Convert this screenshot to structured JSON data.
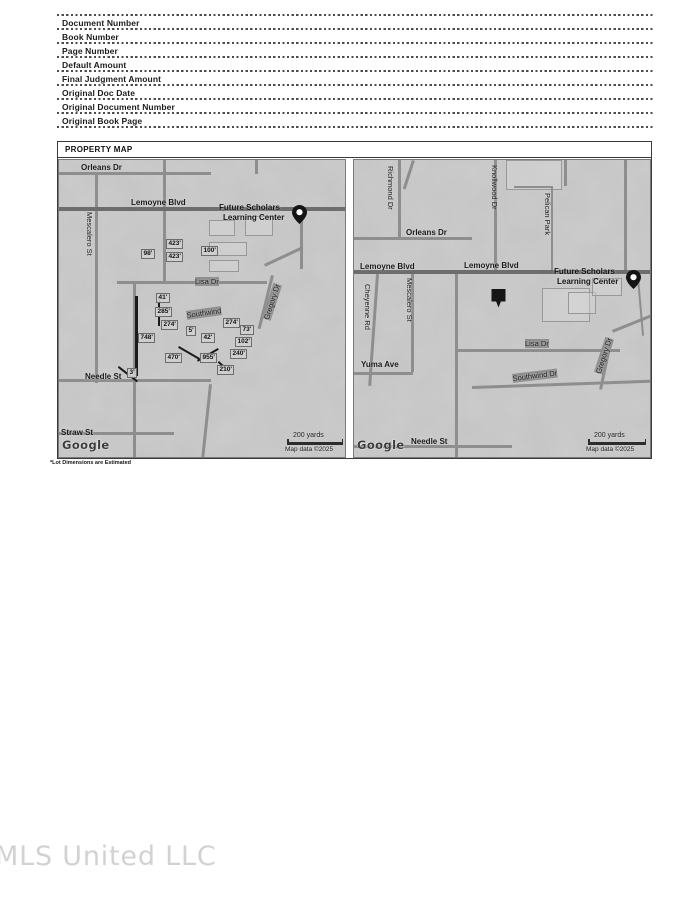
{
  "form": {
    "fields": [
      "Document Number",
      "Book Number",
      "Page Number",
      "Default Amount",
      "Final Judgment Amount",
      "Original Doc Date",
      "Original Document Number",
      "Original Book Page"
    ]
  },
  "property_map": {
    "title": "PROPERTY MAP",
    "footnote": "*Lot Dimensions are Estimated",
    "maps": {
      "left": {
        "labels": [
          {
            "t": "Orleans Dr",
            "x": 22,
            "y": 3,
            "cls": "roadb"
          },
          {
            "t": "Lemoyne Blvd",
            "x": 72,
            "y": 38,
            "cls": "roadb"
          },
          {
            "t": "Mescalero St",
            "x": 26,
            "y": 52,
            "cls": "vert"
          },
          {
            "t": "Future Scholars",
            "x": 160,
            "y": 43,
            "cls": "poi"
          },
          {
            "t": "Learning Center",
            "x": 164,
            "y": 53,
            "cls": "poi"
          },
          {
            "t": "98'",
            "x": 82,
            "y": 89,
            "cls": "dim"
          },
          {
            "t": "423'",
            "x": 107,
            "y": 79,
            "cls": "dim"
          },
          {
            "t": "423'",
            "x": 107,
            "y": 92,
            "cls": "dim"
          },
          {
            "t": "100'",
            "x": 142,
            "y": 86,
            "cls": "dim"
          },
          {
            "t": "Lisa Dr",
            "x": 136,
            "y": 117,
            "cls": "road"
          },
          {
            "t": "Gregory Dr",
            "x": 203,
            "y": 158,
            "cls": "road",
            "rot": -72
          },
          {
            "t": "41'",
            "x": 97,
            "y": 133,
            "cls": "dim"
          },
          {
            "t": "285'",
            "x": 96,
            "y": 147,
            "cls": "dim"
          },
          {
            "t": "Southwind",
            "x": 127,
            "y": 151,
            "cls": "road",
            "rot": -8
          },
          {
            "t": "274'",
            "x": 102,
            "y": 160,
            "cls": "dim"
          },
          {
            "t": "748'",
            "x": 79,
            "y": 173,
            "cls": "dim"
          },
          {
            "t": "5'",
            "x": 127,
            "y": 166,
            "cls": "dim"
          },
          {
            "t": "42'",
            "x": 142,
            "y": 173,
            "cls": "dim"
          },
          {
            "t": "274'",
            "x": 164,
            "y": 158,
            "cls": "dim"
          },
          {
            "t": "73'",
            "x": 181,
            "y": 165,
            "cls": "dim"
          },
          {
            "t": "102'",
            "x": 176,
            "y": 177,
            "cls": "dim"
          },
          {
            "t": "240'",
            "x": 171,
            "y": 189,
            "cls": "dim"
          },
          {
            "t": "470'",
            "x": 106,
            "y": 193,
            "cls": "dim"
          },
          {
            "t": "955'",
            "x": 141,
            "y": 193,
            "cls": "dim"
          },
          {
            "t": "210'",
            "x": 158,
            "y": 205,
            "cls": "dim"
          },
          {
            "t": "3'",
            "x": 68,
            "y": 208,
            "cls": "dim"
          },
          {
            "t": "Needle St",
            "x": 26,
            "y": 212,
            "cls": "roadb"
          },
          {
            "t": "Straw St",
            "x": 2,
            "y": 268,
            "cls": "roadb"
          },
          {
            "t": "Google",
            "x": 3,
            "y": 278,
            "cls": "google"
          },
          {
            "t": "200 yards",
            "x": 234,
            "y": 272,
            "cls": "scalelab"
          },
          {
            "t": "Map data ©2025",
            "x": 226,
            "y": 286,
            "cls": "attrib"
          }
        ],
        "scale_bar": {
          "x": 228,
          "y": 282,
          "w": 56
        },
        "markers": [
          {
            "type": "location-pin",
            "x": 233,
            "y": 45
          }
        ],
        "roads": [
          {
            "x": 0,
            "y": 12,
            "w": 152,
            "h": 3
          },
          {
            "x": 104,
            "y": 0,
            "w": 3,
            "h": 49
          },
          {
            "x": 196,
            "y": 0,
            "w": 3,
            "h": 14
          },
          {
            "x": 36,
            "y": 13,
            "w": 3,
            "h": 210
          },
          {
            "x": 0,
            "y": 47,
            "w": 288,
            "h": 4,
            "major": true
          },
          {
            "x": 104,
            "y": 51,
            "w": 3,
            "h": 72
          },
          {
            "x": 58,
            "y": 121,
            "w": 150,
            "h": 3
          },
          {
            "x": 205,
            "y": 104,
            "w": 42,
            "h": 3,
            "rot": -25
          },
          {
            "x": 212,
            "y": 115,
            "w": 3,
            "h": 55,
            "rot": 14
          },
          {
            "x": 241,
            "y": 57,
            "w": 3,
            "h": 52
          },
          {
            "x": 74,
            "y": 123,
            "w": 3,
            "h": 176
          },
          {
            "x": 0,
            "y": 219,
            "w": 152,
            "h": 3
          },
          {
            "x": 0,
            "y": 272,
            "w": 115,
            "h": 3
          },
          {
            "x": 150,
            "y": 224,
            "w": 3,
            "h": 75,
            "rot": 6
          }
        ],
        "outlines": [
          {
            "x": 150,
            "y": 60,
            "w": 26,
            "h": 16
          },
          {
            "x": 150,
            "y": 82,
            "w": 38,
            "h": 14
          },
          {
            "x": 186,
            "y": 56,
            "w": 28,
            "h": 20
          },
          {
            "x": 150,
            "y": 100,
            "w": 30,
            "h": 12
          }
        ],
        "marks": [
          {
            "x": 76,
            "y": 136,
            "w": 3,
            "h": 80
          },
          {
            "x": 120,
            "y": 186,
            "w": 24,
            "h": 2,
            "rot": 30
          },
          {
            "x": 138,
            "y": 200,
            "w": 24,
            "h": 2,
            "rot": -30
          },
          {
            "x": 160,
            "y": 201,
            "w": 16,
            "h": 2,
            "rot": 42
          },
          {
            "x": 60,
            "y": 206,
            "w": 24,
            "h": 2,
            "rot": 38
          },
          {
            "x": 99,
            "y": 136,
            "w": 2,
            "h": 12
          },
          {
            "x": 99,
            "y": 156,
            "w": 2,
            "h": 10
          }
        ]
      },
      "right": {
        "labels": [
          {
            "t": "Richmond Dr",
            "x": 32,
            "y": 6,
            "cls": "vert"
          },
          {
            "t": "Knollwood Dr",
            "x": 136,
            "y": 5,
            "cls": "vert"
          },
          {
            "t": "Pelican Park",
            "x": 189,
            "y": 33,
            "cls": "vert"
          },
          {
            "t": "Orleans Dr",
            "x": 52,
            "y": 68,
            "cls": "roadb"
          },
          {
            "t": "Lemoyne Blvd",
            "x": 6,
            "y": 102,
            "cls": "roadb"
          },
          {
            "t": "Lemoyne Blvd",
            "x": 110,
            "y": 101,
            "cls": "roadb"
          },
          {
            "t": "Future Scholars",
            "x": 200,
            "y": 107,
            "cls": "poi"
          },
          {
            "t": "Learning Center",
            "x": 203,
            "y": 117,
            "cls": "poi"
          },
          {
            "t": "Cheyenne Rd",
            "x": 9,
            "y": 124,
            "cls": "vert"
          },
          {
            "t": "Mescalero St",
            "x": 51,
            "y": 118,
            "cls": "vert"
          },
          {
            "t": "Lisa Dr",
            "x": 171,
            "y": 179,
            "cls": "road"
          },
          {
            "t": "Gregory Dr",
            "x": 240,
            "y": 212,
            "cls": "road",
            "rot": -72
          },
          {
            "t": "Yuma Ave",
            "x": 7,
            "y": 200,
            "cls": "roadb"
          },
          {
            "t": "Southwind Dr",
            "x": 158,
            "y": 214,
            "cls": "road",
            "rot": -7
          },
          {
            "t": "Needle St",
            "x": 57,
            "y": 277,
            "cls": "roadb"
          },
          {
            "t": "Google",
            "x": 3,
            "y": 278,
            "cls": "google"
          },
          {
            "t": "200 yards",
            "x": 240,
            "y": 272,
            "cls": "scalelab"
          },
          {
            "t": "Map data ©2025",
            "x": 232,
            "y": 286,
            "cls": "attrib"
          }
        ],
        "scale_bar": {
          "x": 234,
          "y": 282,
          "w": 58
        },
        "markers": [
          {
            "type": "location-pin",
            "x": 272,
            "y": 110
          },
          {
            "type": "property-marker",
            "x": 136,
            "y": 128
          }
        ],
        "roads": [
          {
            "x": 0,
            "y": 77,
            "w": 118,
            "h": 3
          },
          {
            "x": 44,
            "y": 0,
            "w": 3,
            "h": 79
          },
          {
            "x": 58,
            "y": 0,
            "w": 3,
            "h": 30,
            "rot": 18
          },
          {
            "x": 140,
            "y": 0,
            "w": 3,
            "h": 111
          },
          {
            "x": 197,
            "y": 26,
            "w": 2,
            "h": 85
          },
          {
            "x": 160,
            "y": 26,
            "w": 39,
            "h": 2
          },
          {
            "x": 210,
            "y": 0,
            "w": 3,
            "h": 26
          },
          {
            "x": 0,
            "y": 110,
            "w": 298,
            "h": 4,
            "major": true
          },
          {
            "x": 57,
            "y": 114,
            "w": 3,
            "h": 98
          },
          {
            "x": 22,
            "y": 114,
            "w": 3,
            "h": 112,
            "rot": 4
          },
          {
            "x": 0,
            "y": 212,
            "w": 59,
            "h": 3
          },
          {
            "x": 101,
            "y": 114,
            "w": 3,
            "h": 185
          },
          {
            "x": 101,
            "y": 189,
            "w": 165,
            "h": 3
          },
          {
            "x": 258,
            "y": 170,
            "w": 45,
            "h": 3,
            "rot": -22
          },
          {
            "x": 118,
            "y": 226,
            "w": 180,
            "h": 3,
            "rot": -2
          },
          {
            "x": 253,
            "y": 192,
            "w": 3,
            "h": 38,
            "rot": 12
          },
          {
            "x": 0,
            "y": 285,
            "w": 158,
            "h": 3
          },
          {
            "x": 270,
            "y": 0,
            "w": 3,
            "h": 110
          },
          {
            "x": 283,
            "y": 118,
            "w": 2,
            "h": 58,
            "rot": -5
          }
        ],
        "outlines": [
          {
            "x": 188,
            "y": 128,
            "w": 48,
            "h": 34
          },
          {
            "x": 214,
            "y": 132,
            "w": 28,
            "h": 22
          },
          {
            "x": 152,
            "y": 0,
            "w": 56,
            "h": 30
          },
          {
            "x": 238,
            "y": 118,
            "w": 30,
            "h": 18
          }
        ],
        "marks": []
      }
    }
  },
  "watermark": "MLS United LLC"
}
